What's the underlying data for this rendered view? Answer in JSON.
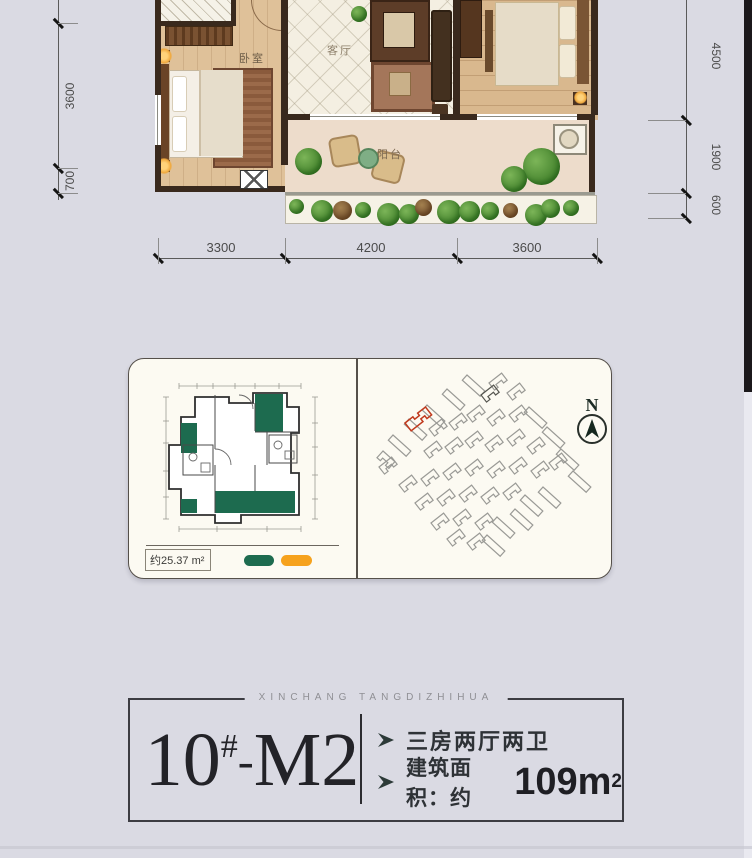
{
  "floor_plan": {
    "room_labels": {
      "bedroom": "卧室",
      "living": "客厅",
      "balcony": "阳台"
    },
    "dimensions": {
      "left": [
        "3600",
        "700"
      ],
      "right": [
        "4500",
        "1900",
        "600"
      ],
      "bottom": [
        "3300",
        "4200",
        "3600"
      ]
    }
  },
  "detail_card": {
    "area_label": "约25.37 m²",
    "legend_colors": {
      "green": "#1d6b4f",
      "orange": "#f6a21d"
    },
    "compass_label": "N",
    "site_colors": {
      "default": "#9a9a96",
      "red": "#c03a1e",
      "dark": "#55554f"
    },
    "site_buildings": [
      [
        98,
        8,
        42,
        1
      ],
      [
        78,
        22,
        42,
        1
      ],
      [
        58,
        38,
        42,
        1
      ],
      [
        40,
        52,
        42,
        1
      ],
      [
        24,
        68,
        42,
        1
      ],
      [
        14,
        84,
        42,
        0
      ],
      [
        10,
        100,
        -38,
        0
      ],
      [
        120,
        16,
        -38,
        0
      ],
      [
        112,
        28,
        -38,
        3
      ],
      [
        138,
        26,
        -38,
        0
      ],
      [
        36,
        56,
        -38,
        2
      ],
      [
        60,
        62,
        -38,
        0
      ],
      [
        80,
        56,
        -38,
        0
      ],
      [
        98,
        48,
        -38,
        0
      ],
      [
        118,
        52,
        -38,
        0
      ],
      [
        140,
        48,
        -38,
        0
      ],
      [
        160,
        40,
        42,
        1
      ],
      [
        178,
        60,
        42,
        1
      ],
      [
        192,
        82,
        42,
        1
      ],
      [
        204,
        104,
        42,
        1
      ],
      [
        55,
        84,
        -38,
        0
      ],
      [
        76,
        80,
        -38,
        0
      ],
      [
        96,
        74,
        -38,
        0
      ],
      [
        116,
        78,
        -38,
        0
      ],
      [
        138,
        72,
        -38,
        0
      ],
      [
        158,
        80,
        -38,
        0
      ],
      [
        30,
        118,
        -38,
        0
      ],
      [
        52,
        112,
        -38,
        0
      ],
      [
        74,
        106,
        -38,
        0
      ],
      [
        96,
        102,
        -38,
        0
      ],
      [
        118,
        104,
        -38,
        0
      ],
      [
        140,
        100,
        -38,
        0
      ],
      [
        162,
        104,
        -38,
        0
      ],
      [
        180,
        96,
        -38,
        0
      ],
      [
        46,
        136,
        -38,
        0
      ],
      [
        68,
        132,
        -38,
        0
      ],
      [
        90,
        128,
        -38,
        0
      ],
      [
        112,
        130,
        -38,
        0
      ],
      [
        134,
        126,
        -38,
        0
      ],
      [
        156,
        128,
        42,
        1
      ],
      [
        174,
        120,
        42,
        1
      ],
      [
        62,
        156,
        -38,
        0
      ],
      [
        84,
        152,
        -38,
        0
      ],
      [
        106,
        156,
        -38,
        0
      ],
      [
        128,
        150,
        42,
        1
      ],
      [
        146,
        142,
        42,
        1
      ],
      [
        78,
        172,
        -38,
        0
      ],
      [
        98,
        176,
        -38,
        0
      ],
      [
        118,
        168,
        42,
        1
      ]
    ]
  },
  "info_box": {
    "header": "XINCHANG TANGDIZHIHUA",
    "unit_number": "10",
    "unit_hash": "#",
    "unit_separator": "-",
    "unit_model": "M2",
    "features": [
      {
        "text": "三房两厅两卫"
      },
      {
        "prefix": "建筑面积：约",
        "big": "109m",
        "sup": "2"
      }
    ]
  }
}
